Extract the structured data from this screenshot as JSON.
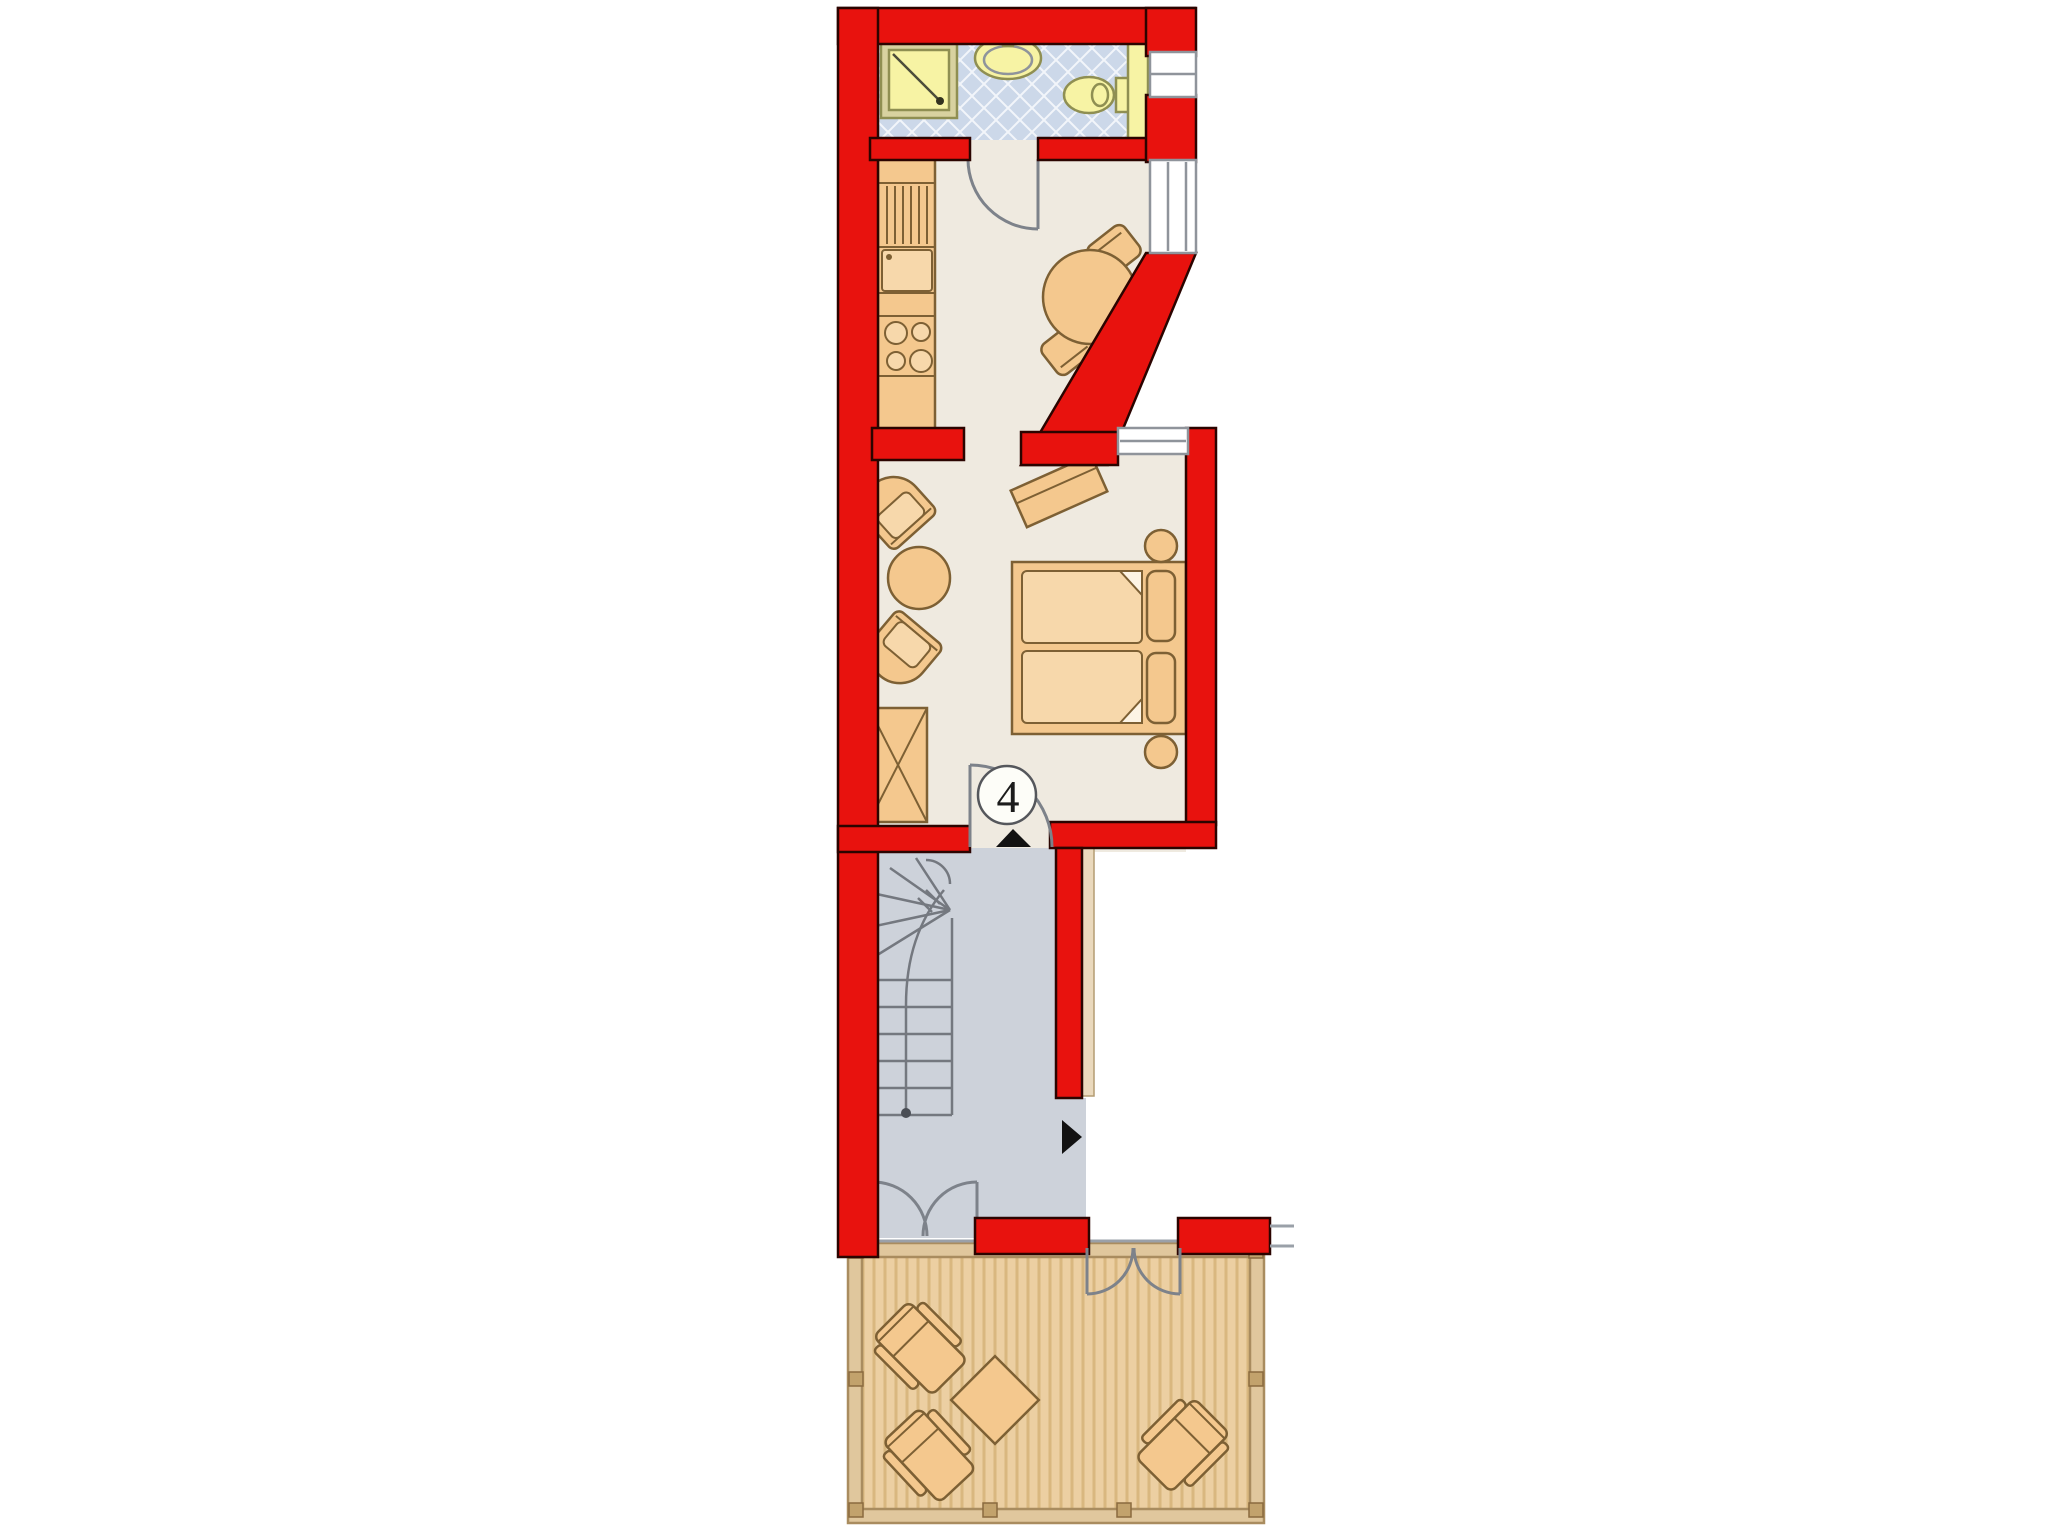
{
  "unit": {
    "label": "4"
  },
  "icons": {
    "entry_arrow": "triangle-up",
    "neighbor_entry_arrow": "triangle-right"
  },
  "colors": {
    "wall-red": "#e8120e",
    "wall-outline": "#2b0400",
    "floor-cream": "#efeae0",
    "tile-blue": "#ccd8e9",
    "stair-gray": "#cdd2da",
    "deck-tan": "#eccfa2",
    "deck-stripe": "#d9b77f",
    "furniture-tan": "#f4c88e",
    "furniture-outline": "#7d6034",
    "fixture-yellow": "#f7f3a4",
    "fixture-outline": "#8f8f52",
    "door-swing-gray": "#7d828a",
    "window-gray": "#8f949b",
    "arrow-black": "#121212"
  }
}
